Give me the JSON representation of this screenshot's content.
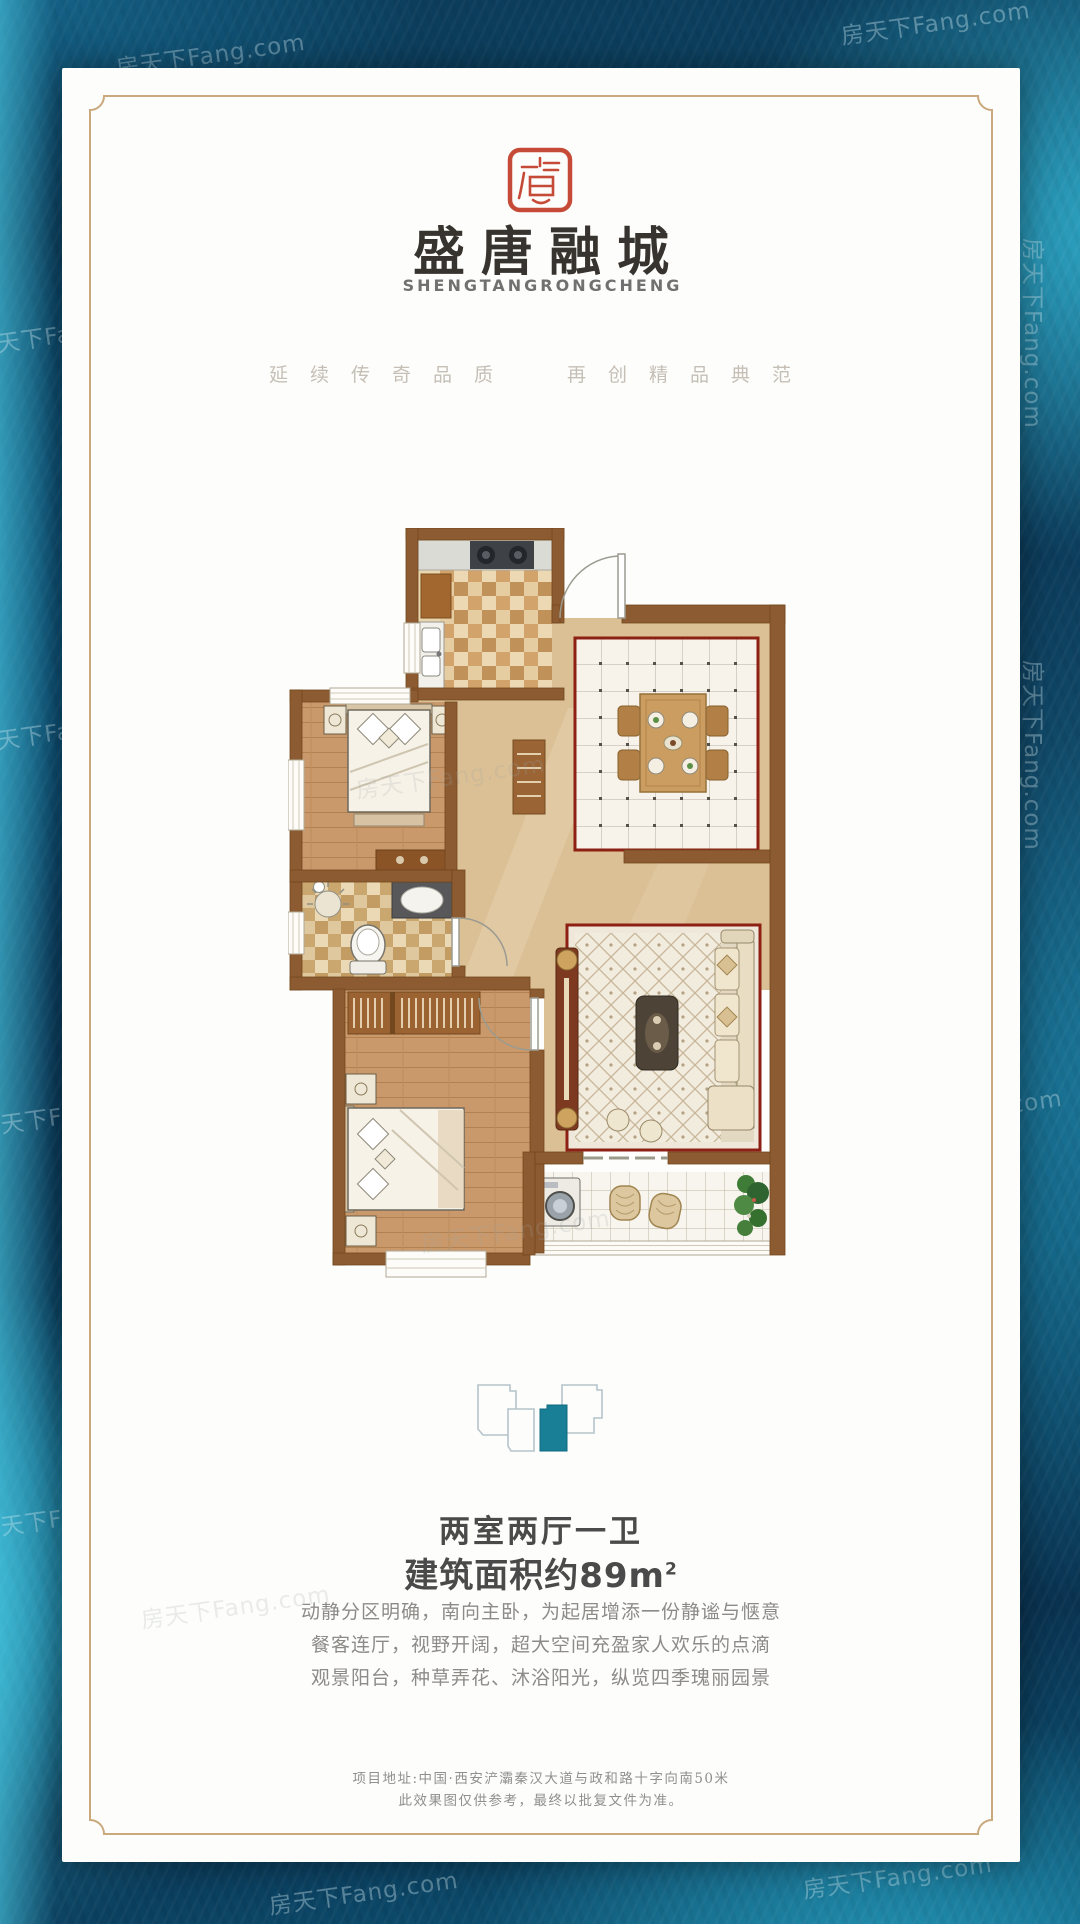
{
  "brand": {
    "name_cn": "盛唐融城",
    "name_en": "SHENGTANGRONGCHENG",
    "tagline_left": "延续传奇品质",
    "tagline_right": "再创精品典范"
  },
  "unit": {
    "layout_text": "两室两厅一卫",
    "area_text": "建筑面积约89m",
    "area_sup": "2"
  },
  "description": {
    "lines": [
      "动静分区明确，南向主卧，为起居增添一份静谧与惬意",
      "餐客连厅，视野开阔，超大空间充盈家人欢乐的点滴",
      "观景阳台，种草弄花、沐浴阳光，纵览四季瑰丽园景"
    ]
  },
  "footer": {
    "address": "项目地址:中国·西安浐灞秦汉大道与政和路十字向南50米",
    "disclaimer": "此效果图仅供参考，最终以批复文件为准。"
  },
  "watermark": {
    "text": "房天下Fang.com"
  },
  "colors": {
    "seal_red": "#c64a38",
    "plan_wall_brown": "#8d5b31",
    "plan_border_red": "#8e1f14",
    "unit_highlight_teal": "#187f97",
    "background_teal": "#0c4a6a"
  }
}
